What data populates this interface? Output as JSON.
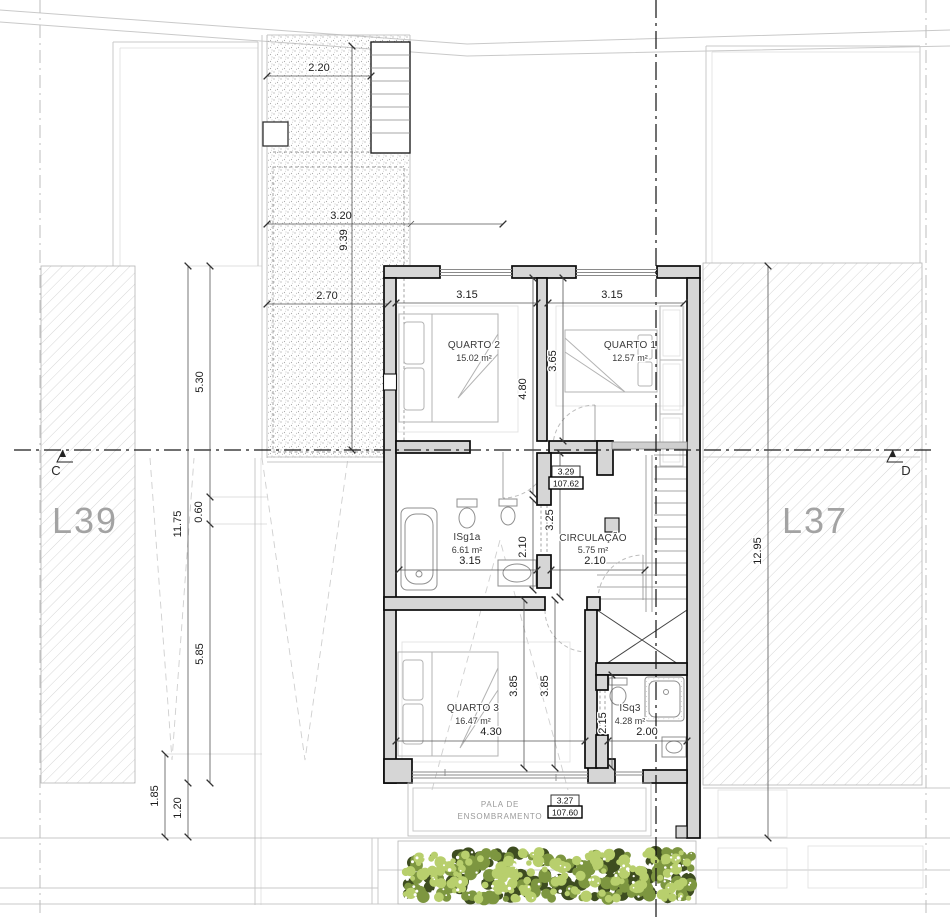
{
  "drawing": {
    "lot_left": "L39",
    "lot_right": "L37",
    "section_left": "C",
    "section_right": "D"
  },
  "rooms": {
    "quarto2": {
      "name": "QUARTO 2",
      "area": "15.02 m²"
    },
    "quarto1": {
      "name": "QUARTO 1",
      "area": "12.57 m²"
    },
    "isg1a": {
      "name": "ISg1a",
      "area": "6.61 m²"
    },
    "circulacao": {
      "name": "CIRCULAÇÃO",
      "area": "5.75 m²"
    },
    "quarto3": {
      "name": "QUARTO 3",
      "area": "16.47 m²"
    },
    "isq3": {
      "name": "ISq3",
      "area": "4.28 m²"
    }
  },
  "canopy": {
    "line1": "PALA DE",
    "line2": "ENSOMBRAMENTO"
  },
  "levels": {
    "upper": {
      "height": "3.29",
      "elevation": "107.62"
    },
    "canopy": {
      "height": "3.27",
      "elevation": "107.60"
    }
  },
  "dims": {
    "terrace_top_w": "2.20",
    "terrace_mid_w": "3.20",
    "terrace_low_w": "2.70",
    "terrace_h": "9.39",
    "left_upper": "5.30",
    "left_total": "11.75",
    "left_step": "0.60",
    "left_lower": "5.85",
    "left_court": "1.85",
    "left_canopy": "1.20",
    "q2_w": "3.15",
    "q1_w": "3.15",
    "q2_h": "4.80",
    "q1_h": "3.65",
    "circ_v": "3.25",
    "isg_v": "2.10",
    "isg_w": "3.15",
    "circ_w": "2.10",
    "q3_v1": "3.85",
    "q3_v2": "3.85",
    "q3_w": "4.30",
    "isq3_v": "2.15",
    "isq3_w": "2.00",
    "right_total": "12.95"
  },
  "colors": {
    "wall_fill": "#d6d6d6",
    "hatch_line": "#cccccc",
    "stipple_dot": "#a3a3a3",
    "lot_label": "#a3a3a3",
    "hedge_dark": "#3e4d20",
    "hedge_mid": "#7d9640",
    "hedge_light": "#b8cf6d",
    "hedge_speck": "#ffffff"
  }
}
